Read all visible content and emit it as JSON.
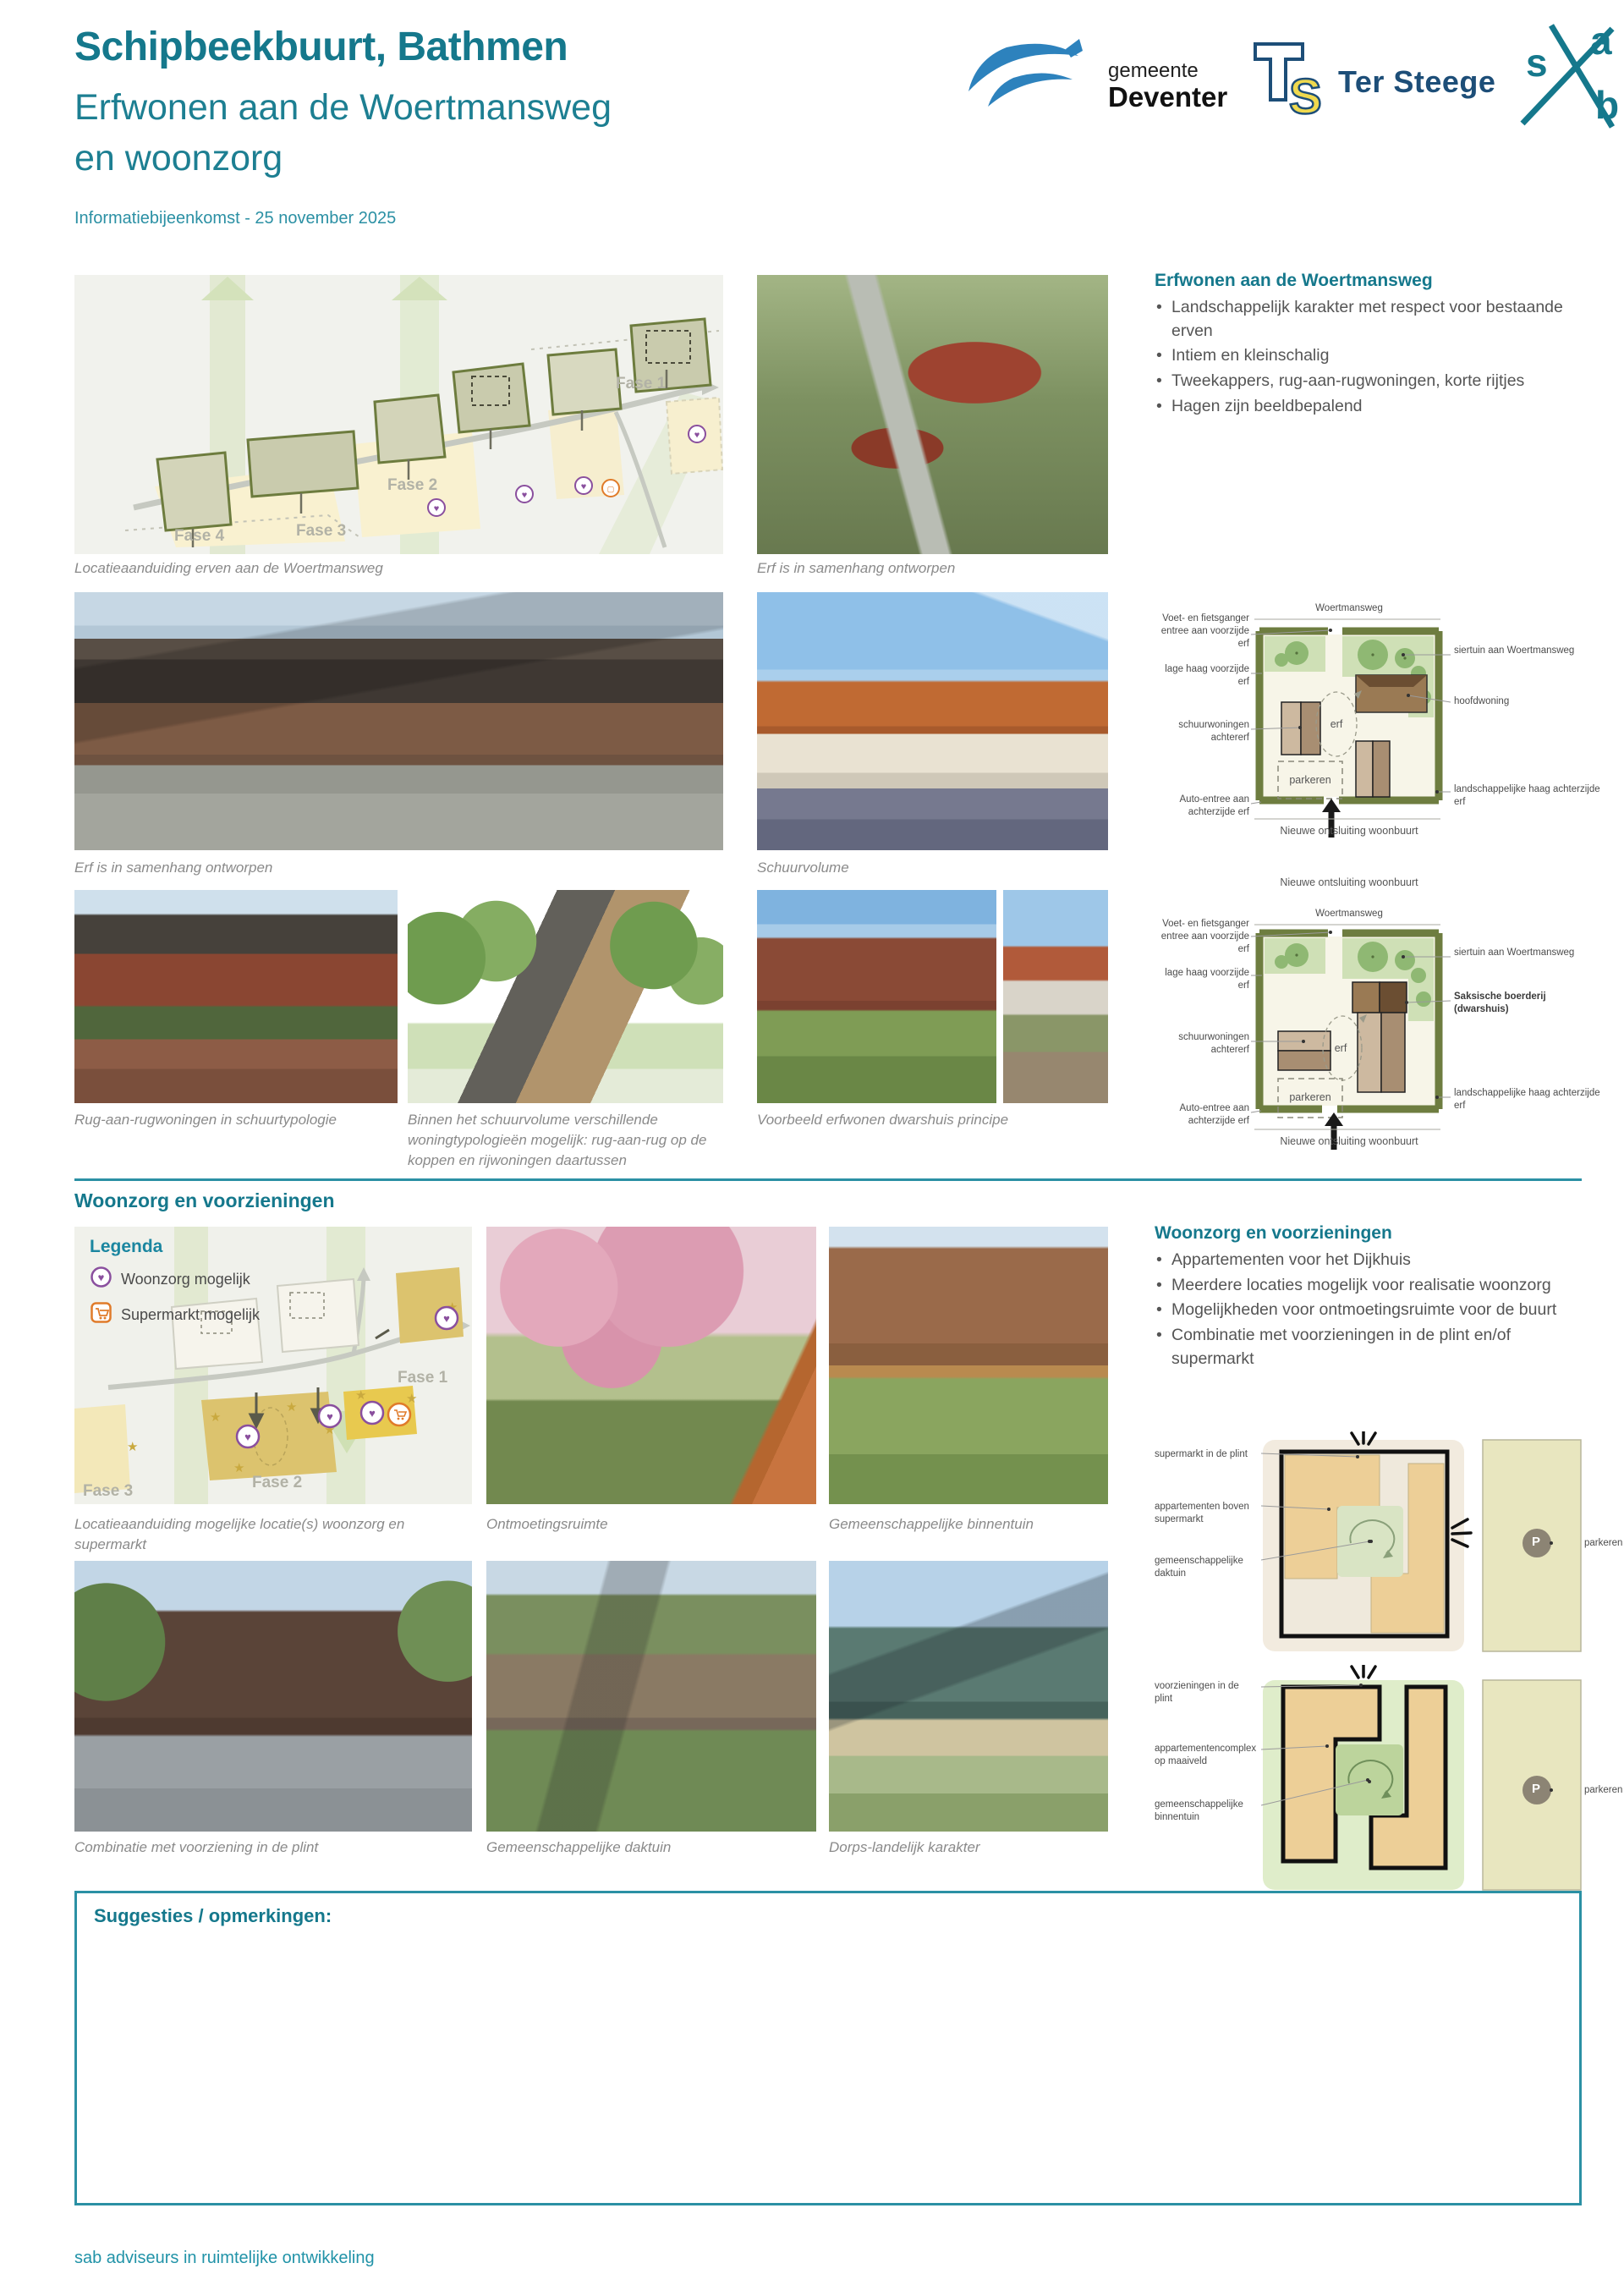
{
  "header": {
    "title": "Schipbeekbuurt, Bathmen",
    "subtitle": [
      "Erfwonen aan de Woertmansweg",
      "en woonzorg"
    ],
    "event": "Informatiebijeenkomst - 25 november 2025"
  },
  "logos": {
    "deventer": {
      "small": "gemeente",
      "name": "Deventer"
    },
    "tersteege": {
      "name": "Ter Steege"
    },
    "sab": {
      "s": "s",
      "a": "a",
      "b": "b"
    }
  },
  "colors": {
    "accent_teal": "#15788c",
    "divider_teal": "#2b90a4",
    "legend_purple": "#8a4f9e",
    "legend_orange": "#e07b2a",
    "map_highlight_yellow": "#dcc36e"
  },
  "erfwonen": {
    "heading": "Erfwonen aan de Woertmansweg",
    "bullets": [
      "Landschappelijk karakter met respect voor bestaande erven",
      "Intiem en kleinschalig",
      "Tweekappers, rug-aan-rugwoningen, korte rijtjes",
      "Hagen zijn beeldbepalend"
    ],
    "captions": {
      "locatie": "Locatieaanduiding erven aan de Woertmansweg",
      "samenhang1": "Erf is in samenhang ontworpen",
      "samenhang2": "Erf is in samenhang ontworpen",
      "schuurvolume": "Schuurvolume",
      "rug": "Rug-aan-rugwoningen in schuurtypologie",
      "binnen": "Binnen het schuurvolume verschillende woningtypologieën mogelijk: rug-aan-rug op de koppen en rijwoningen daartussen",
      "voorbeeld": "Voorbeeld erfwonen dwarshuis principe"
    },
    "map_fases": [
      "Fase 1",
      "Fase 2",
      "Fase 3",
      "Fase 4"
    ]
  },
  "woonzorg": {
    "heading": "Woonzorg en voorzieningen",
    "bullets": [
      "Appartementen voor het Dijkhuis",
      "Meerdere locaties mogelijk voor realisatie woonzorg",
      "Mogelijkheden voor ontmoetingsruimte voor de buurt",
      "Combinatie met voorzieningen in de plint en/of supermarkt"
    ],
    "legend": {
      "title": "Legenda",
      "woonzorg": "Woonzorg mogelijk",
      "supermarkt": "Supermarkt mogelijk"
    },
    "captions": {
      "locatie": "Locatieaanduiding mogelijke locatie(s) woonzorg en supermarkt",
      "ontmoeting": "Ontmoetingsruimte",
      "binnentuin": "Gemeenschappelijke binnentuin",
      "plint": "Combinatie met voorziening in de plint",
      "daktuin": "Gemeenschappelijke daktuin",
      "dorps": "Dorps-landelijk karakter"
    },
    "map_fases": [
      "Fase 1",
      "Fase 2",
      "Fase 3"
    ]
  },
  "diagram_erf1": {
    "road": "Woertmansweg",
    "left": [
      "Voet- en fietsganger entree aan voorzijde erf",
      "lage haag voorzijde erf",
      "schuurwoningen achtererf",
      "Auto-entree aan achterzijde erf"
    ],
    "right": [
      "siertuin aan Woertmansweg",
      "hoofdwoning",
      "landschappelijke haag achterzijde erf"
    ],
    "erf": "erf",
    "parkeren": "parkeren",
    "bottom": "Nieuwe ontsluiting woonbuurt"
  },
  "diagram_erf2": {
    "top": "Nieuwe ontsluiting woonbuurt",
    "road": "Woertmansweg",
    "left": [
      "Voet- en fietsganger entree aan voorzijde erf",
      "lage haag voorzijde erf",
      "schuurwoningen achtererf",
      "Auto-entree aan achterzijde erf"
    ],
    "right": [
      "siertuin aan Woertmansweg",
      "Saksische boerderij (dwarshuis)",
      "landschappelijke haag achterzijde erf"
    ],
    "erf": "erf",
    "parkeren": "parkeren",
    "bottom": "Nieuwe ontsluiting woonbuurt"
  },
  "diagram_supermarkt": {
    "left": [
      "supermarkt in de plint",
      "appartementen boven supermarkt",
      "gemeenschappelijke daktuin"
    ],
    "p": "P",
    "parkeren": "parkeren"
  },
  "diagram_complex": {
    "left": [
      "voorzieningen in de plint",
      "appartementencomplex op maaiveld",
      "gemeenschappelijke binnentuin"
    ],
    "p": "P",
    "parkeren": "parkeren"
  },
  "suggestions": {
    "label": "Suggesties / opmerkingen:"
  },
  "footer": {
    "credit": "sab adviseurs in ruimtelijke ontwikkeling"
  }
}
